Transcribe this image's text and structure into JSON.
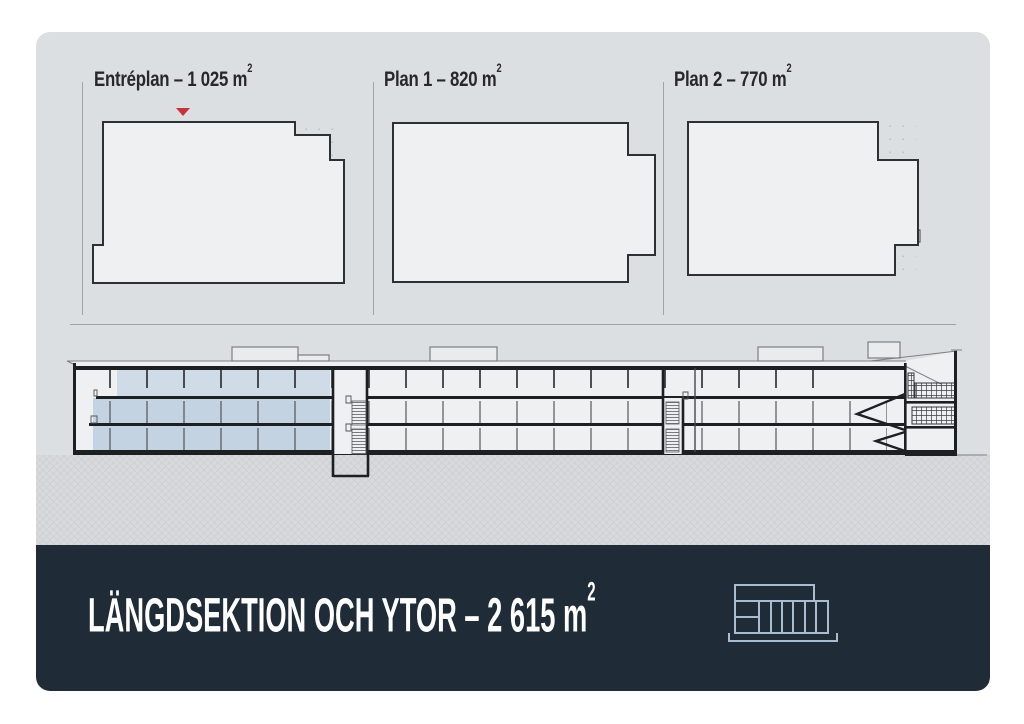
{
  "plans": [
    {
      "label": "Entréplan – 1 025 m",
      "sup": "2"
    },
    {
      "label": "Plan 1 – 820 m",
      "sup": "2"
    },
    {
      "label": "Plan 2 – 770 m",
      "sup": "2"
    }
  ],
  "footer": {
    "title": "LÄNGDSEKTION OCH YTOR – 2 615 m",
    "sup": "2",
    "icon": "building-section-icon"
  },
  "colors": {
    "page_bg": "#ffffff",
    "card_bg": "#dcdfe1",
    "footer_bg": "#202b38",
    "title_text": "#26282b",
    "footer_text": "#ffffff",
    "accent_red": "#c5333b",
    "plan_area_blue": "#c3d3e2",
    "plan_area_blue_light": "#cfdce8",
    "drawing_dark": "#2e3134",
    "divider": "#9fa4a9",
    "icon_stroke": "#aabdd0"
  }
}
